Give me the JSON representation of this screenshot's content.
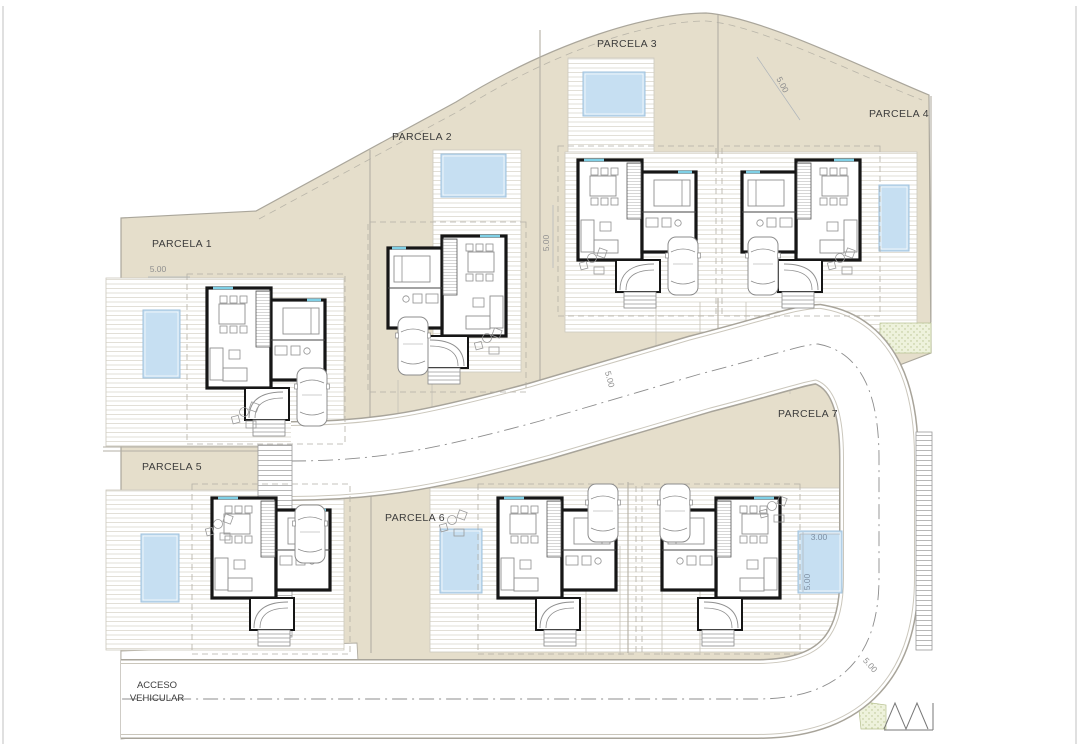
{
  "plan": {
    "colors": {
      "terrain": "#e5decb",
      "terrain_edge": "#aaa69b",
      "divider": "#b3afa4",
      "wall": "#161616",
      "furniture": "#8f8f8f",
      "deck_stroke": "#ccc8bd",
      "road_edge": "#a8a49a",
      "road_inner_edge": "#cbc7bc",
      "centerline": "#8d8d8d",
      "pool_fill": "#c6dff2",
      "pool_stroke": "#9fc0dc",
      "window_accent": "#7fd0e6",
      "label": "#3c3c3c",
      "dim": "#8f8f8f",
      "dim_blue": "#7e8fa2",
      "green_fill": "#eef2dc",
      "green_dot": "#b9c490",
      "page_border": "#c2c2c2"
    },
    "terrain_path": "M 121,218 L 256,211 L 456,102 C 556,40 652,13 706,13 C 762,17 868,70 929,95 L 931,353 L 897,366 C 908,380 914,412 916,452 L 916,560 C 916,646 884,737 758,737 L 121,737 Z",
    "boundary_offset_path": "M 259,219 L 459,111 C 558,48 652,21 706,21 C 760,25 862,77 922,100",
    "acceso_quad": "M 121,651 L 357,643 L 361,716 L 121,739 Z",
    "road": {
      "path": "M 291,461 C 380,461 440,448 540,421 L 700,374 C 770,356 800,345 818,344 C 862,352 879,396 879,458 L 879,578 C 879,652 845,699 757,699 L 121,699",
      "width": 78
    },
    "parcels": [
      {
        "name": "PARCELA 1",
        "x": 152,
        "y": 247
      },
      {
        "name": "PARCELA 2",
        "x": 392,
        "y": 140
      },
      {
        "name": "PARCELA 3",
        "x": 597,
        "y": 47
      },
      {
        "name": "PARCELA 4",
        "x": 869,
        "y": 117
      },
      {
        "name": "PARCELA 5",
        "x": 142,
        "y": 470
      },
      {
        "name": "PARCELA 6",
        "x": 385,
        "y": 521
      },
      {
        "name": "PARCELA 7",
        "x": 778,
        "y": 417
      }
    ],
    "access_label": {
      "lines": [
        "ACCESO",
        "VEHICULAR"
      ],
      "x": 157,
      "y": 688,
      "line_h": 13
    },
    "dimensions": [
      {
        "text": "5.00",
        "x": 158,
        "y": 272,
        "rot": 0
      },
      {
        "text": "5.00",
        "x": 549,
        "y": 243,
        "rot": -90
      },
      {
        "text": "5.00",
        "x": 780,
        "y": 86,
        "rot": 62
      },
      {
        "text": "5.00",
        "x": 607,
        "y": 380,
        "rot": 75
      },
      {
        "text": "3.00",
        "x": 819,
        "y": 540,
        "rot": 0,
        "blue": true
      },
      {
        "text": "5.00",
        "x": 810,
        "y": 582,
        "rot": -90,
        "blue": true
      },
      {
        "text": "5.00",
        "x": 868,
        "y": 667,
        "rot": 48
      }
    ],
    "dim_lines": [
      [
        148,
        277,
        190,
        277
      ],
      [
        553,
        205,
        553,
        268
      ],
      [
        757,
        57,
        800,
        120
      ],
      [
        800,
        534,
        840,
        534
      ],
      [
        803,
        532,
        803,
        592
      ]
    ],
    "decks": [
      {
        "x": 106,
        "y": 278,
        "w": 238,
        "h": 168
      },
      {
        "x": 433,
        "y": 150,
        "w": 88,
        "h": 222
      },
      {
        "x": 568,
        "y": 58,
        "w": 86,
        "h": 104
      },
      {
        "x": 565,
        "y": 152,
        "w": 352,
        "h": 180
      },
      {
        "x": 106,
        "y": 490,
        "w": 238,
        "h": 160
      },
      {
        "x": 430,
        "y": 488,
        "w": 420,
        "h": 164
      }
    ],
    "pools": [
      {
        "x": 143,
        "y": 310,
        "w": 37,
        "h": 68
      },
      {
        "x": 441,
        "y": 154,
        "w": 65,
        "h": 43
      },
      {
        "x": 583,
        "y": 72,
        "w": 62,
        "h": 44
      },
      {
        "x": 879,
        "y": 185,
        "w": 30,
        "h": 66
      },
      {
        "x": 141,
        "y": 534,
        "w": 38,
        "h": 68
      },
      {
        "x": 440,
        "y": 529,
        "w": 42,
        "h": 64
      },
      {
        "x": 798,
        "y": 531,
        "w": 44,
        "h": 62
      }
    ],
    "houses": [
      {
        "parcel": 1,
        "x": 207,
        "y": 288,
        "mirror": false
      },
      {
        "parcel": 2,
        "x": 388,
        "y": 236,
        "mirror": true
      },
      {
        "parcel": 3,
        "x": 578,
        "y": 160,
        "mirror": false
      },
      {
        "parcel": 4,
        "x": 742,
        "y": 160,
        "mirror": true
      },
      {
        "parcel": 5,
        "x": 212,
        "y": 498,
        "mirror": false
      },
      {
        "parcel": 6,
        "x": 498,
        "y": 498,
        "mirror": false
      },
      {
        "parcel": 7,
        "x": 662,
        "y": 498,
        "mirror": true
      }
    ],
    "cars": [
      {
        "x": 297,
        "y": 368
      },
      {
        "x": 398,
        "y": 317
      },
      {
        "x": 668,
        "y": 237
      },
      {
        "x": 748,
        "y": 237
      },
      {
        "x": 295,
        "y": 505
      },
      {
        "x": 588,
        "y": 484
      },
      {
        "x": 660,
        "y": 484
      }
    ],
    "patios": [
      {
        "x": 244,
        "y": 412
      },
      {
        "x": 487,
        "y": 338
      },
      {
        "x": 592,
        "y": 258
      },
      {
        "x": 840,
        "y": 258
      },
      {
        "x": 218,
        "y": 524
      },
      {
        "x": 452,
        "y": 520
      },
      {
        "x": 772,
        "y": 506
      }
    ],
    "dividers": [
      [
        370,
        150,
        370,
        452
      ],
      [
        540,
        30,
        540,
        424
      ],
      [
        718,
        15,
        718,
        158
      ],
      [
        718,
        298,
        718,
        386
      ],
      [
        371,
        490,
        371,
        653
      ],
      [
        628,
        482,
        628,
        653
      ],
      [
        103,
        447,
        258,
        447
      ],
      [
        103,
        451,
        258,
        451
      ],
      [
        931,
        96,
        931,
        322
      ]
    ],
    "driveway_lines": [
      [
        656,
        302,
        656,
        394
      ],
      [
        700,
        302,
        700,
        394
      ],
      [
        746,
        302,
        746,
        394
      ],
      [
        790,
        302,
        790,
        394
      ],
      [
        586,
        546,
        586,
        655
      ],
      [
        620,
        546,
        620,
        655
      ],
      [
        662,
        546,
        662,
        655
      ],
      [
        700,
        546,
        700,
        655
      ],
      [
        398,
        380,
        398,
        450
      ],
      [
        432,
        380,
        432,
        450
      ]
    ],
    "stair_strips": [
      {
        "x": 258,
        "y": 445,
        "w": 34,
        "h": 192
      },
      {
        "x": 916,
        "y": 432,
        "w": 16,
        "h": 218
      }
    ],
    "green_strip": {
      "x": 880,
      "y": 323,
      "w": 51,
      "h": 30
    },
    "green_triangle": "M 858,701 L 886,705 L 886,729 L 861,729 Z",
    "fence_zigzag": "M 884,729 L 895,703 L 906,729 L 917,703 L 928,729",
    "fence_base": [
      884,
      730,
      933,
      730
    ],
    "fence_post": [
      933,
      703,
      933,
      730
    ],
    "page_borders": [
      [
        3,
        6,
        3,
        744
      ],
      [
        1076,
        6,
        1076,
        744
      ]
    ]
  }
}
